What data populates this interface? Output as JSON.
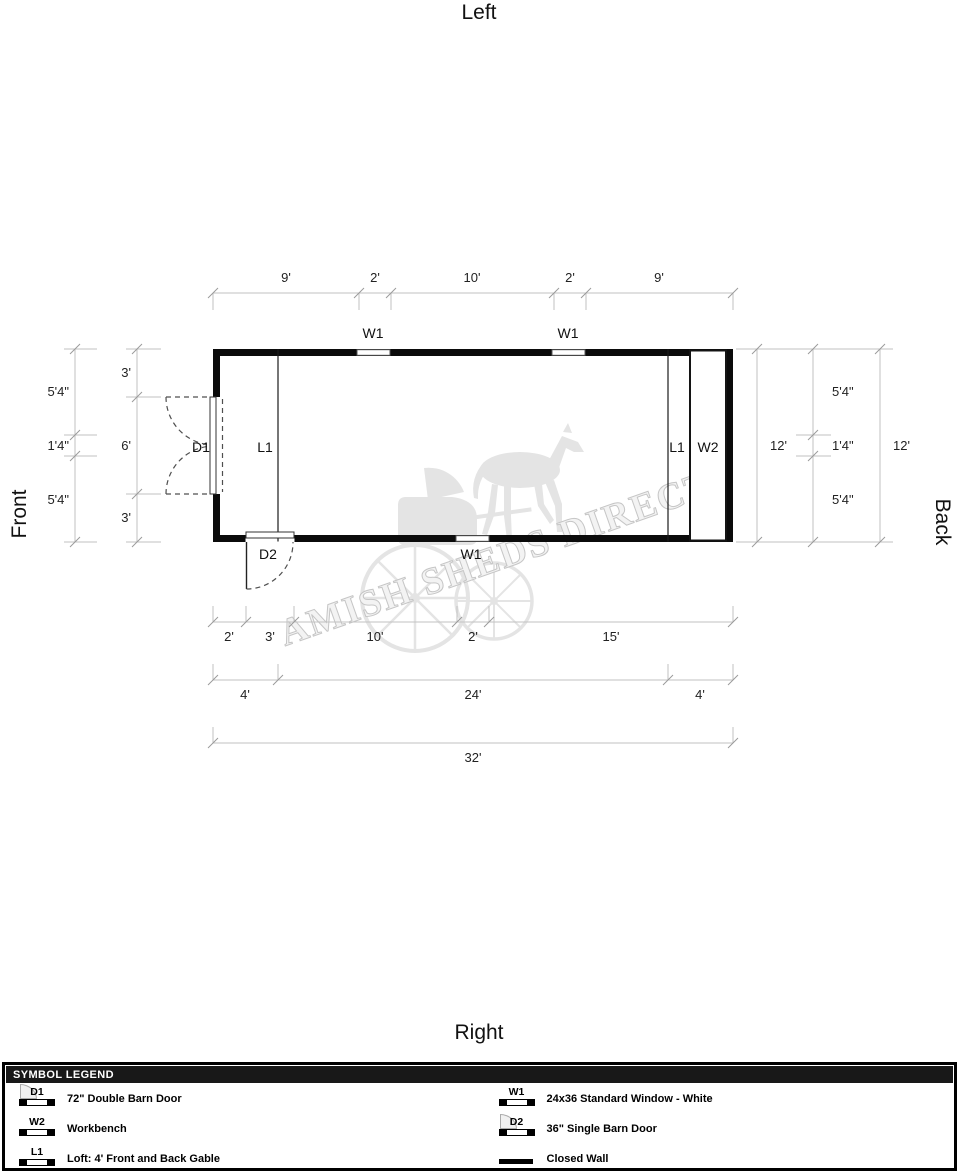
{
  "orientation": {
    "top": "Left",
    "bottom": "Right",
    "left": "Front",
    "right": "Back"
  },
  "watermark": {
    "text": "AMISH SHEDS DIRECT"
  },
  "plan": {
    "labels": {
      "d1": "D1",
      "d2": "D2",
      "w1": "W1",
      "w2": "W2",
      "l1": "L1"
    }
  },
  "dimensions": {
    "top": [
      "9'",
      "2'",
      "10'",
      "2'",
      "9'"
    ],
    "left_outer": [
      "5'4\"",
      "1'4\"",
      "5'4\""
    ],
    "left_inner": [
      "3'",
      "6'",
      "3'"
    ],
    "right_inner_total": "12'",
    "right_mid": [
      "5'4\"",
      "1'4\"",
      "5'4\""
    ],
    "right_outer_total": "12'",
    "bottom_row1": [
      "2'",
      "3'",
      "10'",
      "2'",
      "15'"
    ],
    "bottom_row2": [
      "4'",
      "24'",
      "4'"
    ],
    "bottom_total": "32'"
  },
  "legend": {
    "header": "SYMBOL LEGEND",
    "left_items": [
      {
        "code": "D1",
        "label": "72\" Double Barn Door"
      },
      {
        "code": "W2",
        "label": "Workbench"
      },
      {
        "code": "L1",
        "label": "Loft: 4' Front and Back Gable"
      }
    ],
    "right_items": [
      {
        "code": "W1",
        "label": "24x36 Standard Window - White"
      },
      {
        "code": "D2",
        "label": "36\" Single Barn Door"
      },
      {
        "code": "",
        "label": "Closed Wall"
      }
    ]
  }
}
